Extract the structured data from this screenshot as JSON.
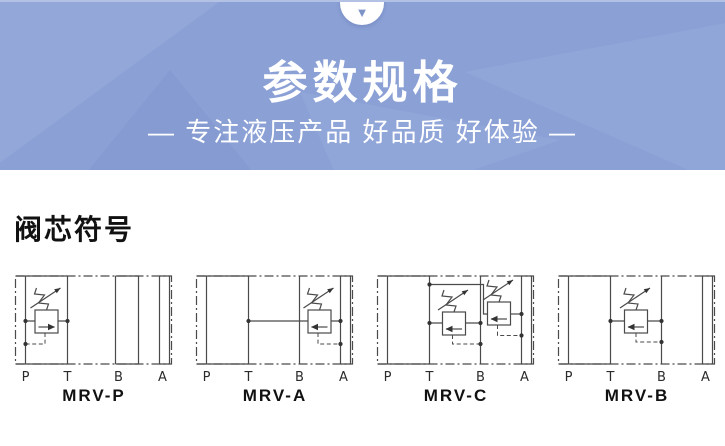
{
  "banner": {
    "arrow_icon": "▼",
    "title": "参数规格",
    "subtitle": "— 专注液压产品 好品质 好体验 —",
    "bg_color": "#8ba1d6"
  },
  "section": {
    "heading": "阀芯符号"
  },
  "diagrams": [
    {
      "name": "MRV-P",
      "ports": {
        "p": "P",
        "t": "T",
        "b": "B",
        "a": "A"
      }
    },
    {
      "name": "MRV-A",
      "ports": {
        "p": "P",
        "t": "T",
        "b": "B",
        "a": "A"
      }
    },
    {
      "name": "MRV-C",
      "ports": {
        "p": "P",
        "t": "T",
        "b": "B",
        "a": "A"
      }
    },
    {
      "name": "MRV-B",
      "ports": {
        "p": "P",
        "t": "T",
        "b": "B",
        "a": "A"
      }
    }
  ]
}
